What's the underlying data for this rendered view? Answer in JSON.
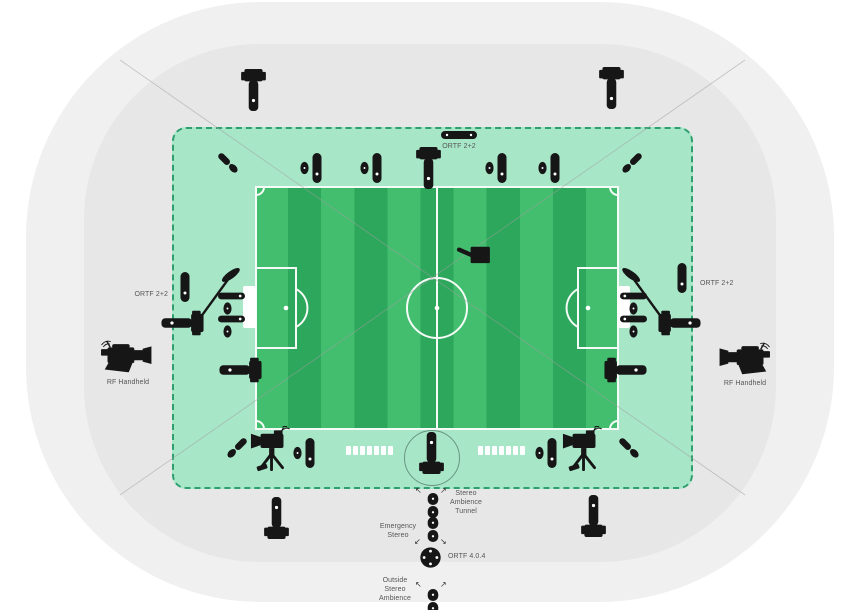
{
  "diagram": {
    "type": "football-stadium-broadcast-audio-coverage",
    "labels": {
      "ortf_2_2_top": "ORTF 2+2",
      "ortf_2_2_left": "ORTF 2+2",
      "ortf_2_2_right": "ORTF 2+2",
      "rf_handheld_left": "RF Handheld",
      "rf_handheld_right": "RF Handheld",
      "stereo_ambience_tunnel": "Stereo Ambience Tunnel",
      "emergency_stereo": "Emergency Stereo",
      "ortf_4_0_4": "ORTF 4.0.4",
      "outside_stereo_ambience": "Outside Stereo Ambience"
    },
    "glyphs": {
      "arrow_up_left": "↖",
      "arrow_up_right": "↗",
      "arrow_down_left": "↙",
      "arrow_down_right": "↘"
    },
    "colors": {
      "background": "#ffffff",
      "stadium_outer": "#f0f0f0",
      "stadium_inner": "#e7e7e7",
      "ambience_zone": "#a8e6c8",
      "zone_border": "#2da06e",
      "pitch_stripe_light": "#42be6e",
      "pitch_stripe_dark": "#2ca75b",
      "pitch_lines": "#ffffff",
      "icon": "#161616",
      "sightline": "#9f9f9f",
      "label_text": "#565656"
    },
    "icons": {
      "pedestal-camera-icon": "black pedestal camera silhouette",
      "tripod-rf-camera-icon": "black tripod camera with antenna",
      "shoulder-rf-camera-icon": "black shoulder ENG camera with antenna",
      "shotgun-mic-icon": "black horizontal capsule mic",
      "capsule-mic-icon": "black vertical capsule mic",
      "oval-mic-icon": "small black oval mic",
      "angled-mic-pair-icon": "two angled capsule mics",
      "boom-mic-icon": "boom arm with blimp windshield",
      "ortf-bar-icon": "horizontal stereo mic bar",
      "stereo-mic-icon": "double capsule stereo mic",
      "ortf-404-array-icon": "round 4-capsule surround array",
      "spidercam-icon": "overhead cable camera",
      "bench-icon": "white segmented substitutes bench",
      "goal-icon": "white goal rectangle"
    }
  }
}
